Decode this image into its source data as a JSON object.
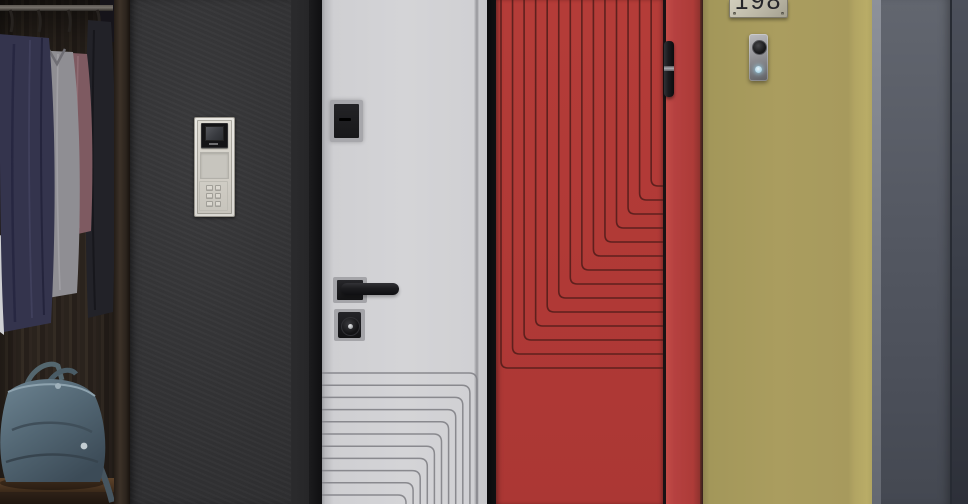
{
  "yellow_door": {
    "number_plate": "198"
  },
  "colors": {
    "charcoal_door": "#323234",
    "white_door": "#d3d3d6",
    "red_door": "#b23a36",
    "yellow_door": "#ab9e5f",
    "metal_frame_gray": "#565b65",
    "intercom_silver": "#d6d3cb",
    "handbag_teal": "#5b7280",
    "pattern_line_white_door": "#85858a",
    "pattern_line_red_door": "#4a1a18"
  }
}
